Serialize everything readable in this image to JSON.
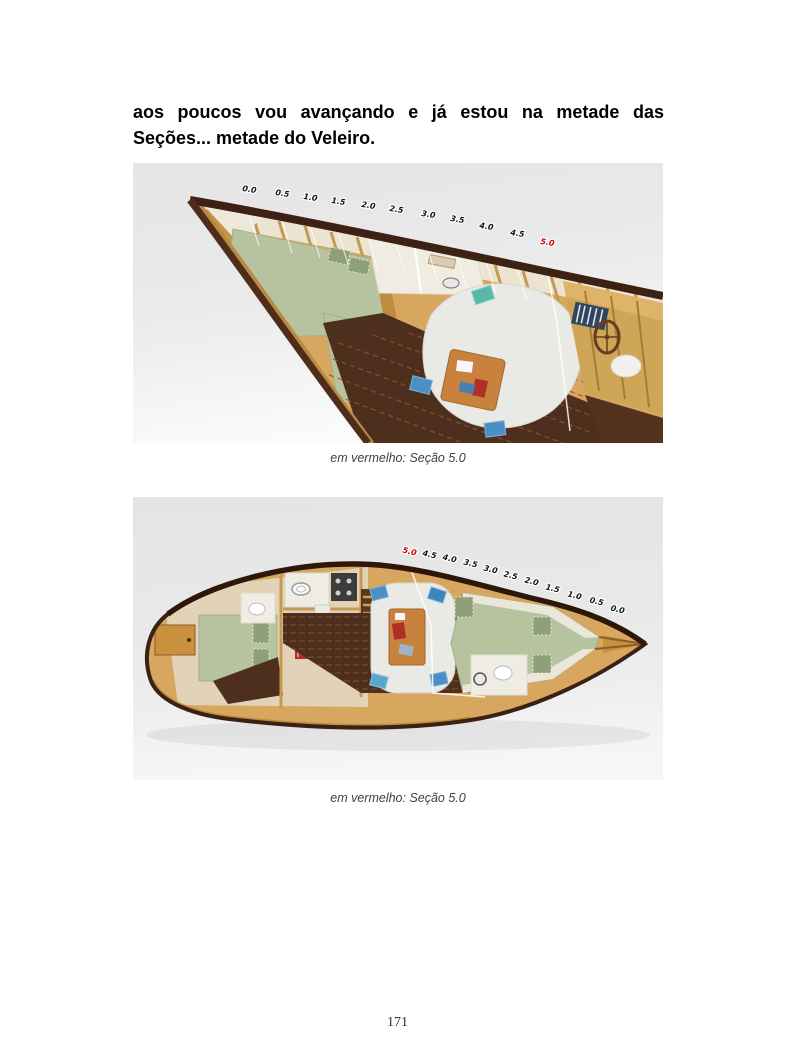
{
  "document": {
    "paragraph": {
      "line1": "aos poucos vou avançando e já estou na metade das",
      "line2": "Seções... metade do Veleiro."
    },
    "page_number": "171"
  },
  "colors": {
    "section_highlight": "#cc0000",
    "section_label": "#151515",
    "hull_wood": "#d8a75f",
    "hull_rim": "#3a2114",
    "floor_wood": "#4e2f1d",
    "berth_green": "#b7c29e",
    "cushion_white": "#e9e9e6",
    "pillow_blue": "#4a90c4",
    "render_background": "#e8e8e8"
  },
  "figure1": {
    "type": "3d-perspective-cutaway",
    "description": "Vista em perspectiva do interior do veleiro, proa à esquerda",
    "sections": [
      "0.0",
      "0.5",
      "1.0",
      "1.5",
      "2.0",
      "2.5",
      "3.0",
      "3.5",
      "4.0",
      "4.5",
      "5.0"
    ],
    "highlighted_section": "5.0",
    "caption": "em vermelho: Seção 5.0"
  },
  "figure2": {
    "type": "top-view-plan",
    "description": "Vista superior do interior do veleiro, proa à direita",
    "sections": [
      "5.0",
      "4.5",
      "4.0",
      "3.5",
      "3.0",
      "2.5",
      "2.0",
      "1.5",
      "1.0",
      "0.5",
      "0.0"
    ],
    "highlighted_section": "5.0",
    "caption": "em vermelho: Seção 5.0"
  }
}
